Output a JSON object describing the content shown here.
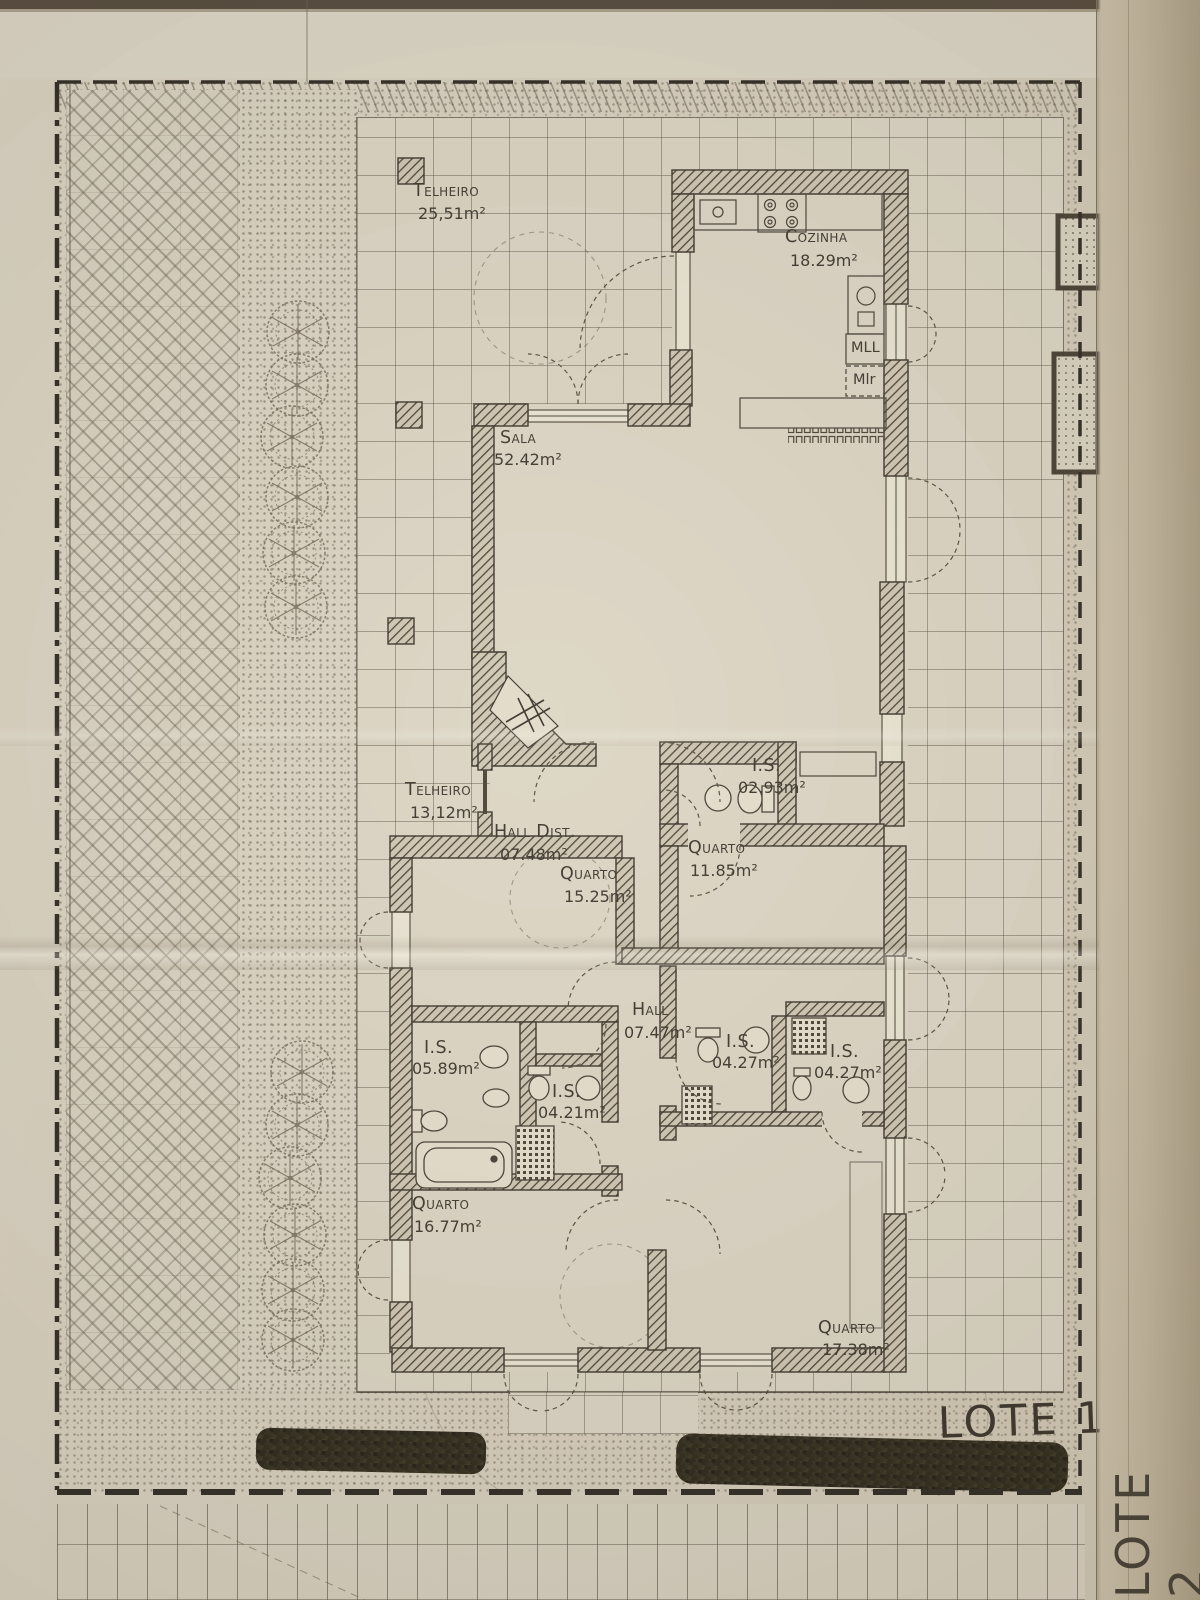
{
  "colors": {
    "paper": "#d8d1c0",
    "ink": "#453f34",
    "wall_fill": "#4a4336",
    "vegetation": "#2e2a1c"
  },
  "rooms": {
    "telheiro_top": {
      "name": "Telheiro",
      "area": "25,51m²"
    },
    "cozinha": {
      "name": "Cozinha",
      "area": "18.29m²"
    },
    "sala": {
      "name": "Sala",
      "area": "52.42m²"
    },
    "telheiro_side": {
      "name": "Telheiro",
      "area": "13,12m²"
    },
    "hall_dist": {
      "name": "Hall Dist.",
      "area": "07.48m²"
    },
    "quarto_1": {
      "name": "Quarto",
      "area": "15.25m²"
    },
    "is_1": {
      "name": "I.S.",
      "area": "02.93m²"
    },
    "quarto_2": {
      "name": "Quarto",
      "area": "11.85m²"
    },
    "hall": {
      "name": "Hall",
      "area": "07.47m²"
    },
    "is_2": {
      "name": "I.S.",
      "area": "05.89m²"
    },
    "is_3": {
      "name": "I.S.",
      "area": "04.21m²"
    },
    "is_4": {
      "name": "I.S.",
      "area": "04.27m²"
    },
    "is_5": {
      "name": "I.S.",
      "area": "04.27m²"
    },
    "quarto_3": {
      "name": "Quarto",
      "area": "16.77m²"
    },
    "quarto_4": {
      "name": "Quarto",
      "area": "17.38m²"
    }
  },
  "kitchen": {
    "dishwasher_label": "MLL",
    "washer_label": "Mlr"
  },
  "lots": {
    "lote1": "LOTE 1",
    "lote2": "LOTE 2"
  }
}
